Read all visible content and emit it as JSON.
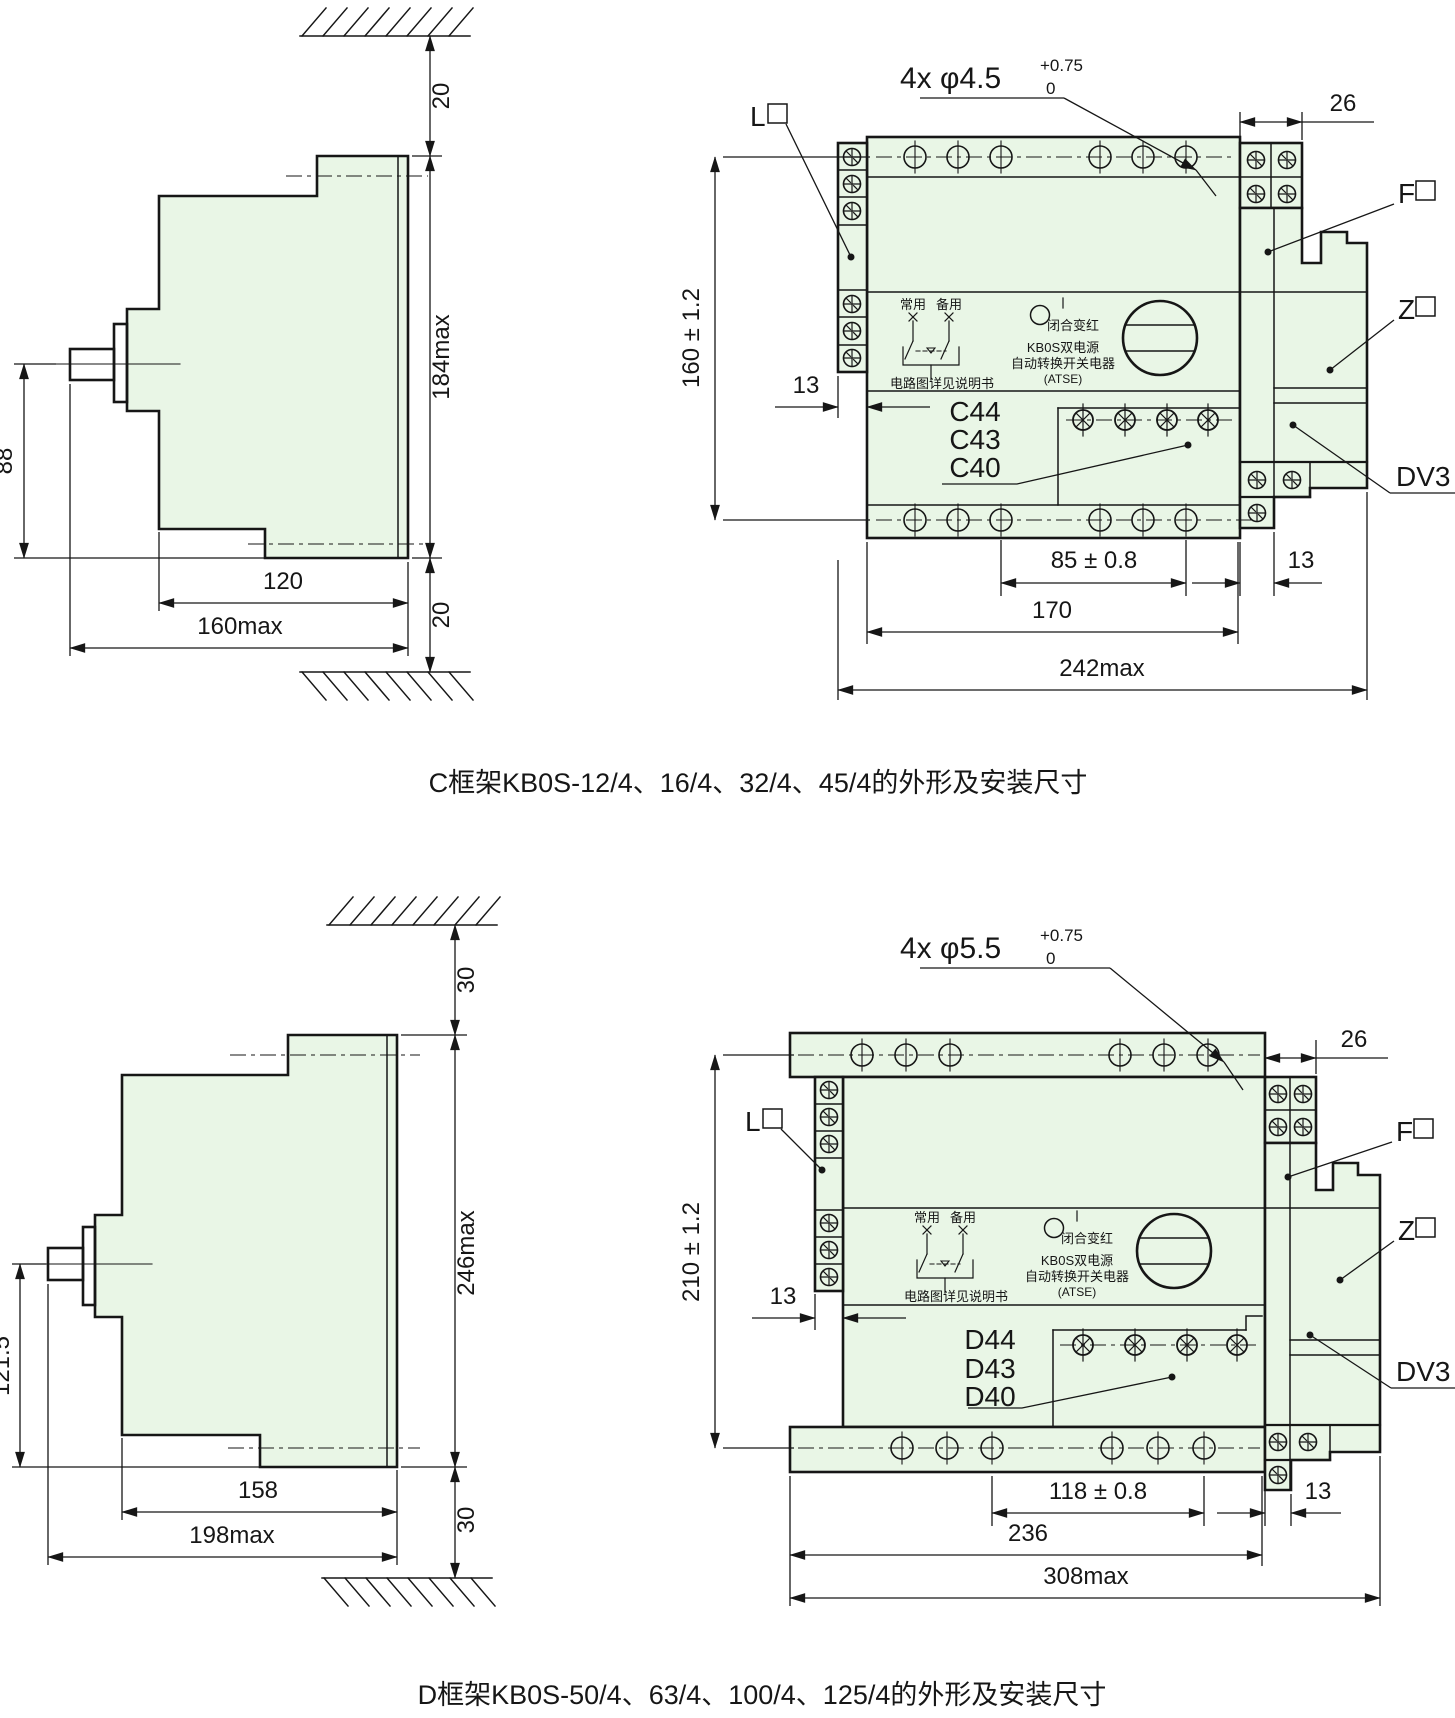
{
  "colors": {
    "body_fill": "#e9f6e6",
    "handle_red": "#f11212",
    "line": "#161616"
  },
  "captions": {
    "c": "C框架KB0S-12/4、16/4、32/4、45/4的外形及安装尺寸",
    "d": "D框架KB0S-50/4、63/4、100/4、125/4的外形及安装尺寸"
  },
  "labels": {
    "l": "L",
    "f": "F",
    "z": "Z",
    "dv3": "DV3"
  },
  "device": {
    "normal": "常用",
    "standby": "备用",
    "closed_red": "闭合变红",
    "brand1": "KB0S双电源",
    "brand2": "自动转换开关电器",
    "brand3": "(ATSE)",
    "circuit_note": "电路图详见说明书"
  },
  "c": {
    "side": {
      "top_gap": "20",
      "height": "184max",
      "handle_height": "88",
      "body_width": "120",
      "total_width": "160max",
      "bottom_gap": "20"
    },
    "front": {
      "hole_note": "4x φ4.5",
      "hole_tol_sup": "+0.75",
      "hole_tol_sub": "0",
      "block_width": "26",
      "height": "160 ± 1.2",
      "strip_width": "13",
      "codes": [
        "C44",
        "C43",
        "C40"
      ],
      "hole_span": "85 ± 0.8",
      "rail_width": "170",
      "total_width": "242max",
      "right_gap": "13"
    }
  },
  "d": {
    "side": {
      "top_gap": "30",
      "height": "246max",
      "handle_height": "121.5",
      "body_width": "158",
      "total_width": "198max",
      "bottom_gap": "30"
    },
    "front": {
      "hole_note": "4x φ5.5",
      "hole_tol_sup": "+0.75",
      "hole_tol_sub": "0",
      "block_width": "26",
      "height": "210 ± 1.2",
      "strip_width": "13",
      "codes": [
        "D44",
        "D43",
        "D40"
      ],
      "hole_span": "118 ± 0.8",
      "rail_width": "236",
      "total_width": "308max",
      "right_gap": "13"
    }
  }
}
